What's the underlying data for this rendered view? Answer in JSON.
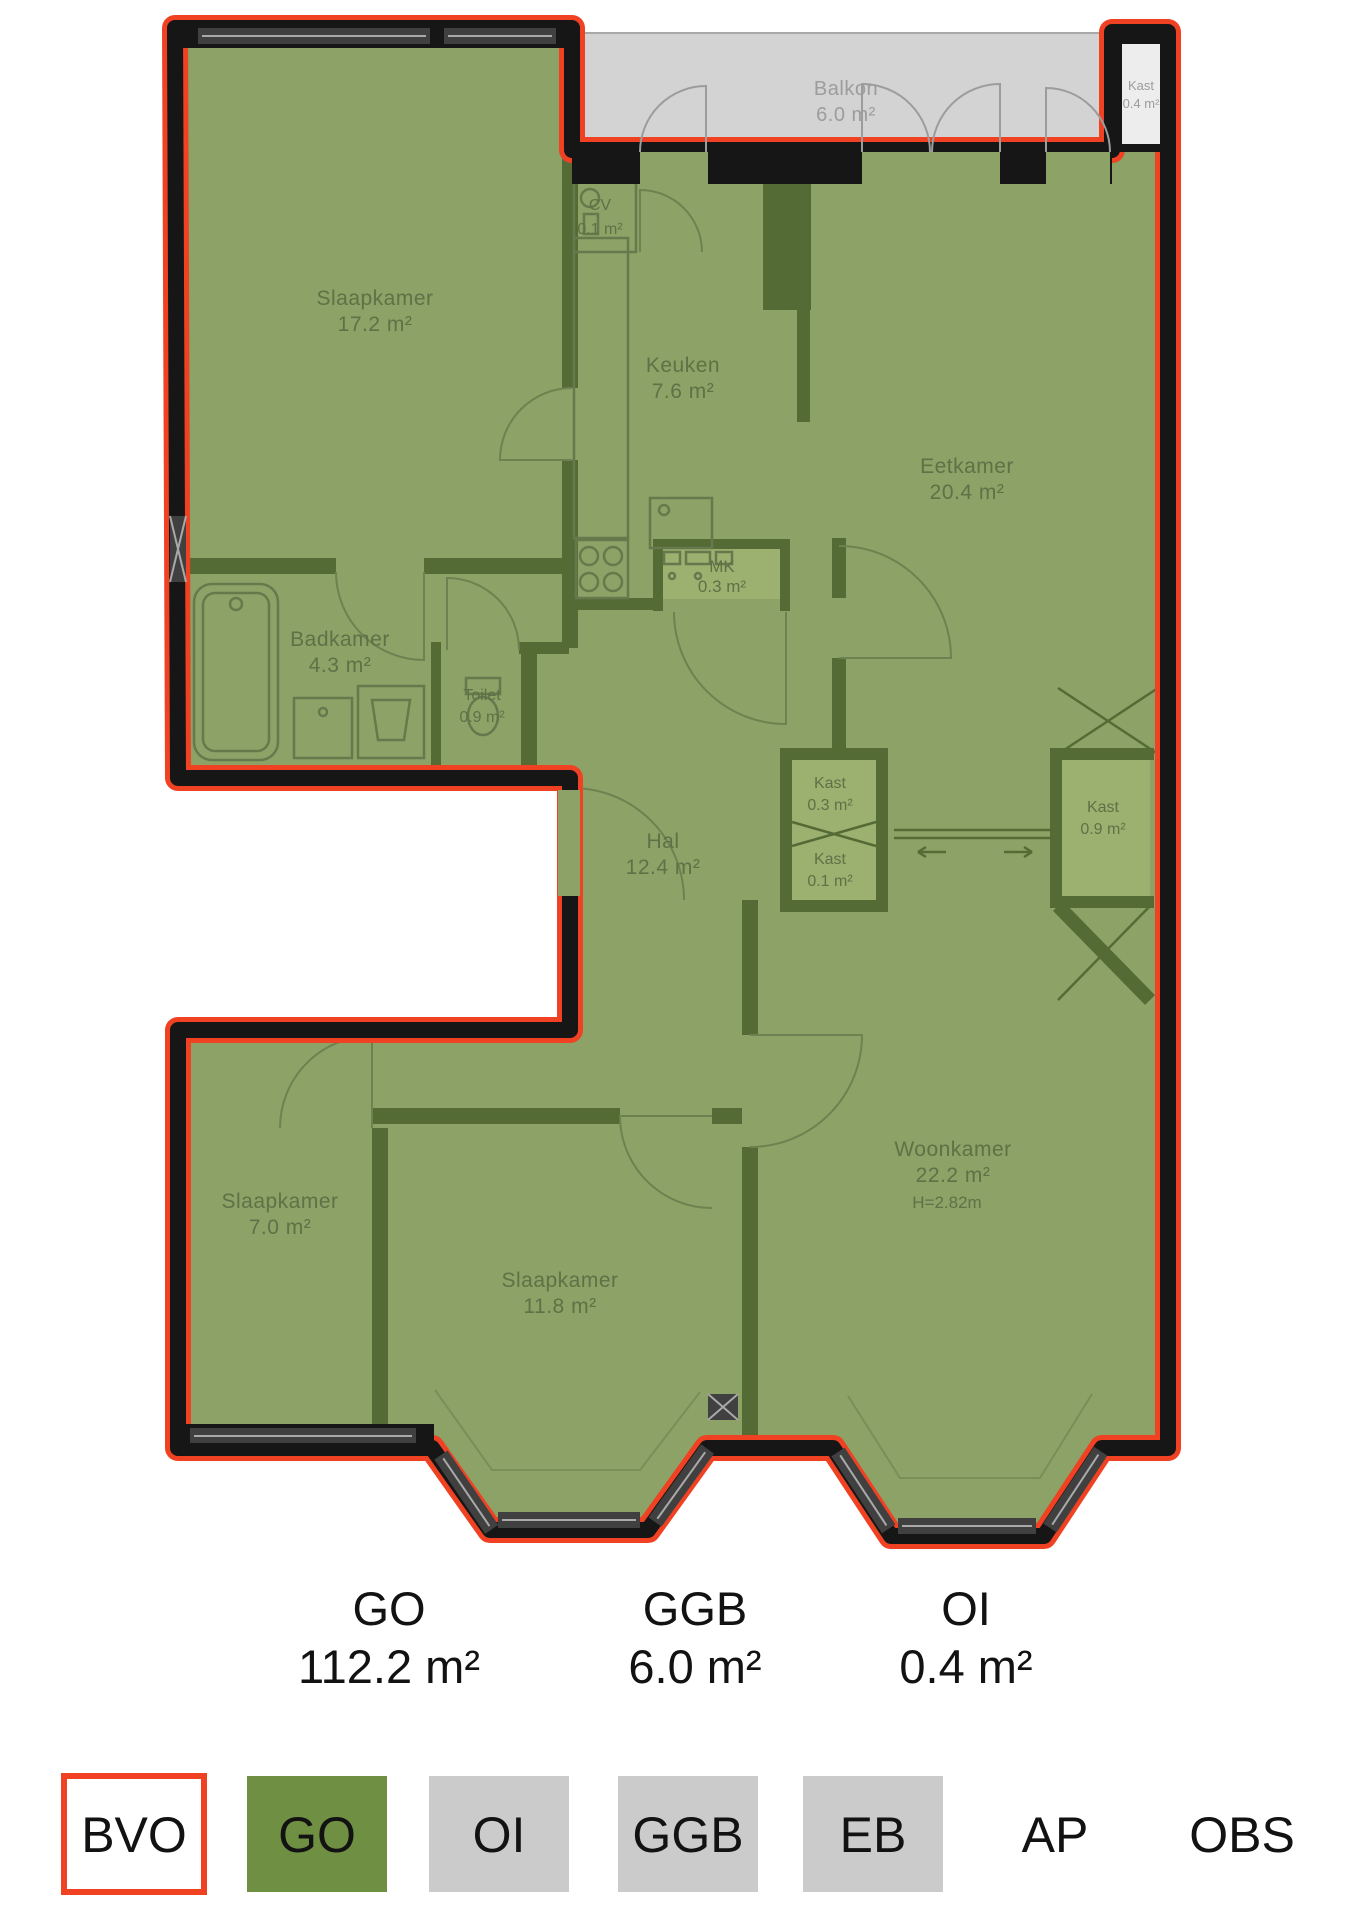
{
  "plan": {
    "rooms": {
      "slaapkamer1": {
        "name": "Slaapkamer",
        "area": "17.2 m²"
      },
      "cv": {
        "name": "CV",
        "area": "0.1 m²"
      },
      "keuken": {
        "name": "Keuken",
        "area": "7.6 m²"
      },
      "eetkamer": {
        "name": "Eetkamer",
        "area": "20.4 m²"
      },
      "mk": {
        "name": "MK",
        "area": "0.3 m²"
      },
      "badkamer": {
        "name": "Badkamer",
        "area": "4.3 m²"
      },
      "toilet": {
        "name": "Toilet",
        "area": "0.9 m²"
      },
      "kast_hal_boven": {
        "name": "Kast",
        "area": "0.3 m²"
      },
      "kast_hal_onder": {
        "name": "Kast",
        "area": "0.1 m²"
      },
      "kast_woonkamer": {
        "name": "Kast",
        "area": "0.9 m²"
      },
      "hal": {
        "name": "Hal",
        "area": "12.4 m²"
      },
      "woonkamer": {
        "name": "Woonkamer",
        "area": "22.2 m²",
        "height": "H=2.82m"
      },
      "slaapkamer2": {
        "name": "Slaapkamer",
        "area": "7.0 m²"
      },
      "slaapkamer3": {
        "name": "Slaapkamer",
        "area": "11.8 m²"
      },
      "balkon": {
        "name": "Balkon",
        "area": "6.0 m²"
      },
      "kast_balkon": {
        "name": "Kast",
        "area": "0.4 m²"
      }
    },
    "colors": {
      "bvo_outline_red": "#F04123",
      "go_green_solid": "#6F8F43",
      "go_green_plan": "#8CA266",
      "wall_dark_green": "#556B36",
      "wall_black": "#161616",
      "balcony_gray": "#D3D3D3",
      "legend_gray": "#CBCBCB"
    }
  },
  "totals": [
    {
      "code": "GO",
      "value": "112.2 m²"
    },
    {
      "code": "GGB",
      "value": "6.0 m²"
    },
    {
      "code": "OI",
      "value": "0.4 m²"
    }
  ],
  "legend": [
    {
      "label": "BVO",
      "swatch": "outline-red"
    },
    {
      "label": "GO",
      "swatch": "green"
    },
    {
      "label": "OI",
      "swatch": "gray"
    },
    {
      "label": "GGB",
      "swatch": "gray"
    },
    {
      "label": "EB",
      "swatch": "gray"
    },
    {
      "label": "AP",
      "swatch": "none"
    },
    {
      "label": "OBS",
      "swatch": "none"
    }
  ]
}
